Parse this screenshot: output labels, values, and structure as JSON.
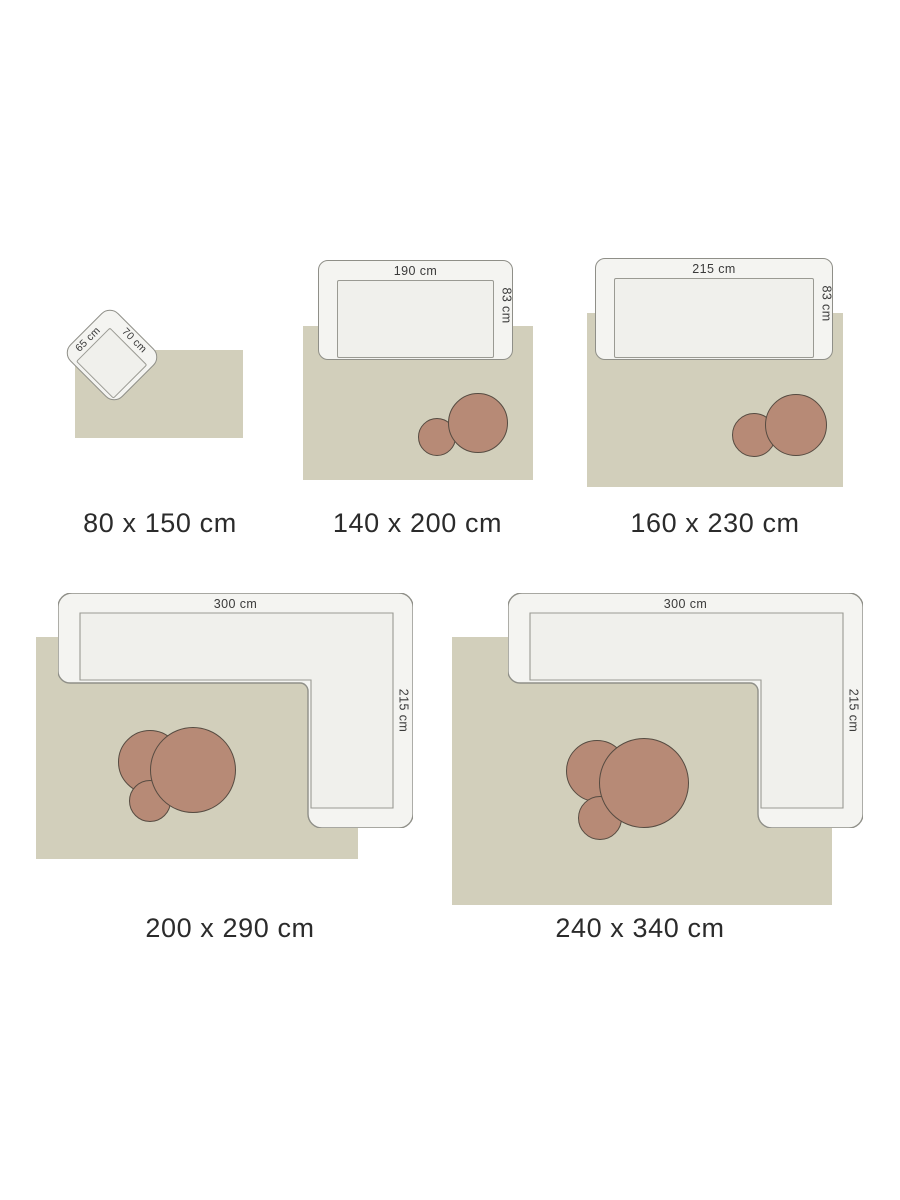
{
  "colors": {
    "background": "#ffffff",
    "rug": "#d2cfbb",
    "sofa_fill": "#f4f4f1",
    "seat_fill": "#f0f0ec",
    "outline": "#8f8f88",
    "seat_line": "#9a9a93",
    "pouf_fill": "#b78a76",
    "pouf_border": "#564b41",
    "text": "#2b2b2b",
    "dim_text": "#3a3a3a"
  },
  "items": [
    {
      "id": "80x150",
      "caption": "80 x 150 cm",
      "furniture": "armchair",
      "width_label": "70 cm",
      "depth_label": "65 cm",
      "pouf_count": 0
    },
    {
      "id": "140x200",
      "caption": "140 x 200 cm",
      "furniture": "sofa",
      "width_label": "190 cm",
      "depth_label": "83 cm",
      "pouf_count": 2
    },
    {
      "id": "160x230",
      "caption": "160 x 230 cm",
      "furniture": "sofa",
      "width_label": "215 cm",
      "depth_label": "83 cm",
      "pouf_count": 2
    },
    {
      "id": "200x290",
      "caption": "200 x 290 cm",
      "furniture": "corner-sofa",
      "width_label": "300 cm",
      "depth_label": "215 cm",
      "pouf_count": 3
    },
    {
      "id": "240x340",
      "caption": "240 x 340 cm",
      "furniture": "corner-sofa",
      "width_label": "300 cm",
      "depth_label": "215 cm",
      "pouf_count": 3
    }
  ]
}
